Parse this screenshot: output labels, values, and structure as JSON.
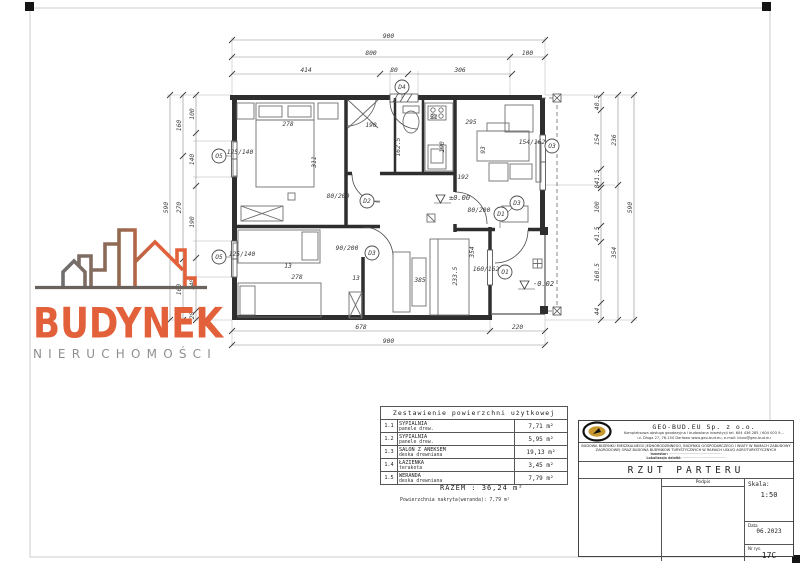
{
  "watermark": {
    "title": "BUDYNEK",
    "subtitle": "NIERUCHOMOŚCI",
    "orange": "#e2613b",
    "gray": "#8f8f8f"
  },
  "plan": {
    "chains": [
      {
        "o": "h",
        "pos": 40,
        "start": 232,
        "segs": [
          [
            313,
            "900"
          ]
        ]
      },
      {
        "o": "h",
        "pos": 57,
        "start": 232,
        "segs": [
          [
            278,
            "800"
          ],
          [
            35,
            "100"
          ]
        ]
      },
      {
        "o": "h",
        "pos": 74,
        "start": 232,
        "segs": [
          [
            148,
            "414"
          ],
          [
            28,
            "80"
          ],
          [
            104,
            "306"
          ]
        ]
      },
      {
        "o": "h",
        "pos": 331,
        "start": 232,
        "segs": [
          [
            258,
            "678"
          ],
          [
            55,
            "220"
          ]
        ]
      },
      {
        "o": "h",
        "pos": 345,
        "start": 232,
        "segs": [
          [
            313,
            "900"
          ]
        ]
      },
      {
        "o": "v",
        "pos": 196,
        "start": 95,
        "segs": [
          [
            38,
            "100"
          ],
          [
            53,
            "140"
          ],
          [
            72,
            "190"
          ],
          [
            53,
            "140"
          ],
          [
            9,
            "20"
          ]
        ]
      },
      {
        "o": "v",
        "pos": 183,
        "start": 95,
        "segs": [
          [
            61,
            "160"
          ],
          [
            103,
            "270"
          ],
          [
            61,
            "160"
          ]
        ]
      },
      {
        "o": "v",
        "pos": 170,
        "start": 95,
        "segs": [
          [
            225,
            "590"
          ]
        ]
      },
      {
        "o": "v",
        "pos": 601,
        "start": 95,
        "segs": [
          [
            15,
            "40.5"
          ],
          [
            59,
            "154"
          ],
          [
            16,
            "41.5"
          ],
          [
            3,
            "8"
          ],
          [
            38,
            "100"
          ],
          [
            16,
            "41.5"
          ],
          [
            61,
            "160.5"
          ],
          [
            17,
            "44"
          ]
        ]
      },
      {
        "o": "v",
        "pos": 618,
        "start": 95,
        "segs": [
          [
            90,
            "236"
          ],
          [
            135,
            "354"
          ]
        ]
      },
      {
        "o": "v",
        "pos": 634,
        "start": 95,
        "segs": [
          [
            225,
            "590"
          ]
        ]
      }
    ],
    "annotations": [
      {
        "t": "278",
        "x": 288,
        "y": 126
      },
      {
        "t": "311",
        "x": 316,
        "y": 162,
        "r": -90
      },
      {
        "t": "190",
        "x": 371,
        "y": 127
      },
      {
        "t": "162.5",
        "x": 400,
        "y": 147,
        "r": -90
      },
      {
        "t": "31",
        "x": 434,
        "y": 119
      },
      {
        "t": "190",
        "x": 444,
        "y": 147,
        "r": -90
      },
      {
        "t": "295",
        "x": 471,
        "y": 124
      },
      {
        "t": "93",
        "x": 485,
        "y": 150,
        "r": -90
      },
      {
        "t": "192",
        "x": 463,
        "y": 179
      },
      {
        "t": "354",
        "x": 474,
        "y": 252,
        "r": -90
      },
      {
        "t": "233.5",
        "x": 457,
        "y": 276,
        "r": -90
      },
      {
        "t": "385",
        "x": 420,
        "y": 282
      },
      {
        "t": "278",
        "x": 297,
        "y": 279
      },
      {
        "t": "13",
        "x": 288,
        "y": 268
      },
      {
        "t": "13",
        "x": 356,
        "y": 280
      },
      {
        "t": "90/200",
        "x": 347,
        "y": 250
      },
      {
        "t": "80/200",
        "x": 338,
        "y": 198
      },
      {
        "t": "80/200",
        "x": 479,
        "y": 212
      },
      {
        "t": "125/140",
        "x": 240,
        "y": 154
      },
      {
        "t": "125/140",
        "x": 242,
        "y": 256
      },
      {
        "t": "154/162",
        "x": 532,
        "y": 144
      },
      {
        "t": "160/162",
        "x": 486,
        "y": 271
      }
    ],
    "circles": [
      {
        "t": "D4",
        "x": 402,
        "y": 87
      },
      {
        "t": "D2",
        "x": 367,
        "y": 201
      },
      {
        "t": "D3",
        "x": 372,
        "y": 253
      },
      {
        "t": "D1",
        "x": 501,
        "y": 214
      },
      {
        "t": "D3",
        "x": 517,
        "y": 203
      },
      {
        "t": "O3",
        "x": 552,
        "y": 146
      },
      {
        "t": "O5",
        "x": 219,
        "y": 156
      },
      {
        "t": "O5",
        "x": 219,
        "y": 257
      },
      {
        "t": "O1",
        "x": 505,
        "y": 272
      }
    ],
    "levels": [
      {
        "t": "±0.00",
        "x": 449,
        "y": 200
      },
      {
        "t": "-0.02",
        "x": 533,
        "y": 286
      }
    ]
  },
  "area_table": {
    "title": "Zestawienie powierzchni użytkowej",
    "rows": [
      {
        "no": "1.1",
        "name": "SYPIALNIA",
        "floor": "panele drew.",
        "area": "7,71 m²"
      },
      {
        "no": "1.2",
        "name": "SYPIALNIA",
        "floor": "panele drew.",
        "area": "5,95 m²"
      },
      {
        "no": "1.3",
        "name": "SALON Z ANEKSEM",
        "floor": "deska drewniana",
        "area": "19,13 m²"
      },
      {
        "no": "1.4",
        "name": "ŁAZIENKA",
        "floor": "terakota",
        "area": "3,45 m²"
      },
      {
        "no": "1.5",
        "name": "WERANDA",
        "floor": "deska drewniana",
        "area": "7,79 m²"
      }
    ],
    "total_label": "RAZEM :",
    "total": "36,24 m²",
    "note": "Powierzchnia nakryta(weranda): 7,79 m²"
  },
  "titleblock": {
    "company": "GEO-BUD.EU  Sp. z o.o.",
    "line1": "Kompleksowa obsługa geodezyjna i budowlana inwestycji   tel. 604 436 285 / 604 003 9…",
    "line2": "ul. Długa 27, 76-150 Darłowo      www.geo-bud.eu,  e-mail: biuro@geo-bud.eu",
    "desc1": "BUDOWA BUDYNKU MIESZKALNEGO JEDNORODZINNEGO, BUDYNKU GOSPODARCZEGO I WIATY W RAMACH ZABUDOWY",
    "desc2": "ZAGRODOWEJ ORAZ BUDOWA BUDYNKÓW TURYSTYCZNYCH W RAMACH USŁUG AGROTURYSTYCZNYCH",
    "inwestor_label": "Inwestor:",
    "inwestor_value": "··················································",
    "lokalizacja_label": "Lokalizacja działki:",
    "lokalizacja_value": "·········································",
    "drawing_title": "RZUT PARTERU",
    "podpis": "Podpis",
    "skala_label": "Skala:",
    "skala": "1:50",
    "data_label": "Data",
    "data": "06.2023",
    "nr_label": "Nr rys.",
    "nr": "17C"
  }
}
